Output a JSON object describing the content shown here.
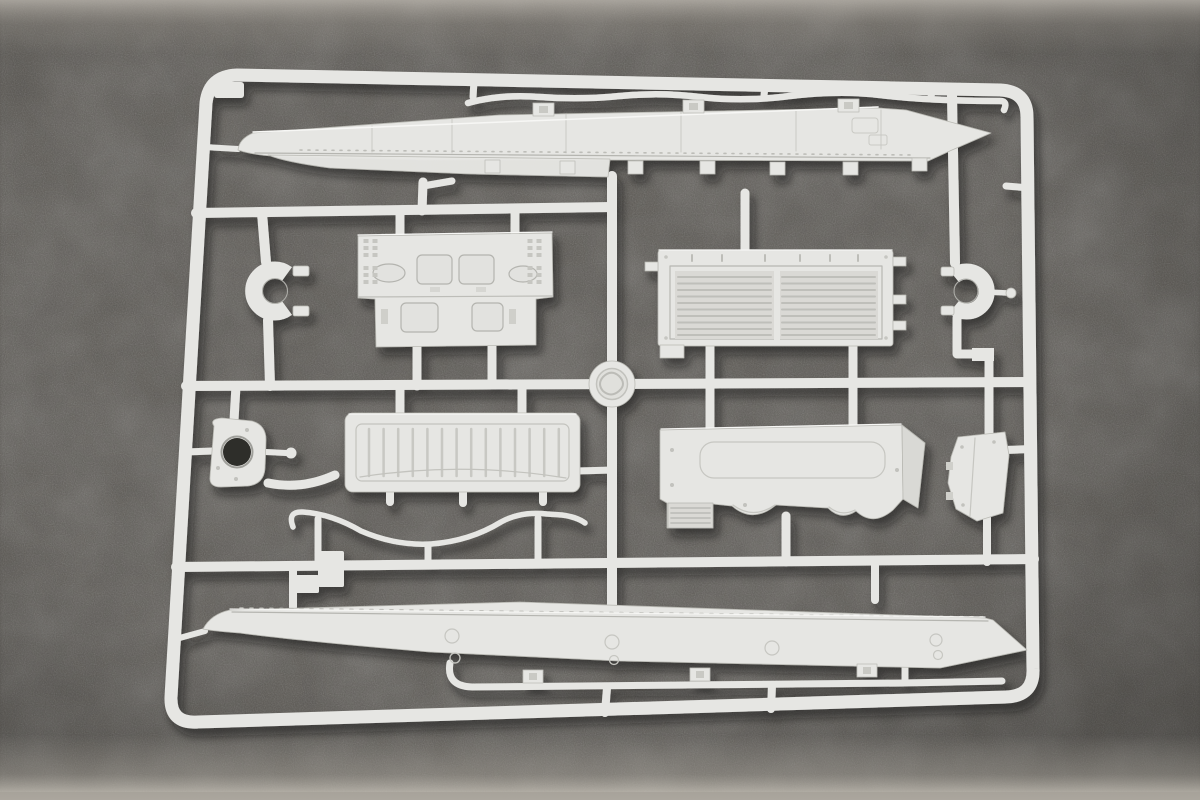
{
  "scene": {
    "subject": "unpainted light-gray injection-molded model kit sprue with tank hull parts photographed on dark gray felt",
    "colors": {
      "felt_base": "#57544f",
      "plastic": "#e6e6e3",
      "plastic_shade": "#c6c6c1",
      "plastic_edge": "#b9b9b3",
      "plastic_deep": "#a9a9a4",
      "plastic_highlight": "#f7f7f5",
      "recess_fill": "#dad9d5",
      "hole_dark": "#2f2d2a"
    },
    "parts": [
      {
        "name": "sprue-frame"
      },
      {
        "name": "runner-network"
      },
      {
        "name": "upper-hull-side-panel"
      },
      {
        "name": "fender-strip-top"
      },
      {
        "name": "clamp-brackets-top"
      },
      {
        "name": "crew-deck-plate"
      },
      {
        "name": "engine-grille-deck"
      },
      {
        "name": "hatch-ring-left"
      },
      {
        "name": "hatch-ring-right"
      },
      {
        "name": "center-hub-disc"
      },
      {
        "name": "mount-plate-left"
      },
      {
        "name": "ribbed-rear-door"
      },
      {
        "name": "engine-access-panel"
      },
      {
        "name": "side-bracket-right"
      },
      {
        "name": "tow-cable-rod"
      },
      {
        "name": "lower-hull-side-panel"
      },
      {
        "name": "fender-strip-bottom"
      },
      {
        "name": "clamp-brackets-bottom"
      },
      {
        "name": "sprue-gate-blocks"
      }
    ]
  }
}
